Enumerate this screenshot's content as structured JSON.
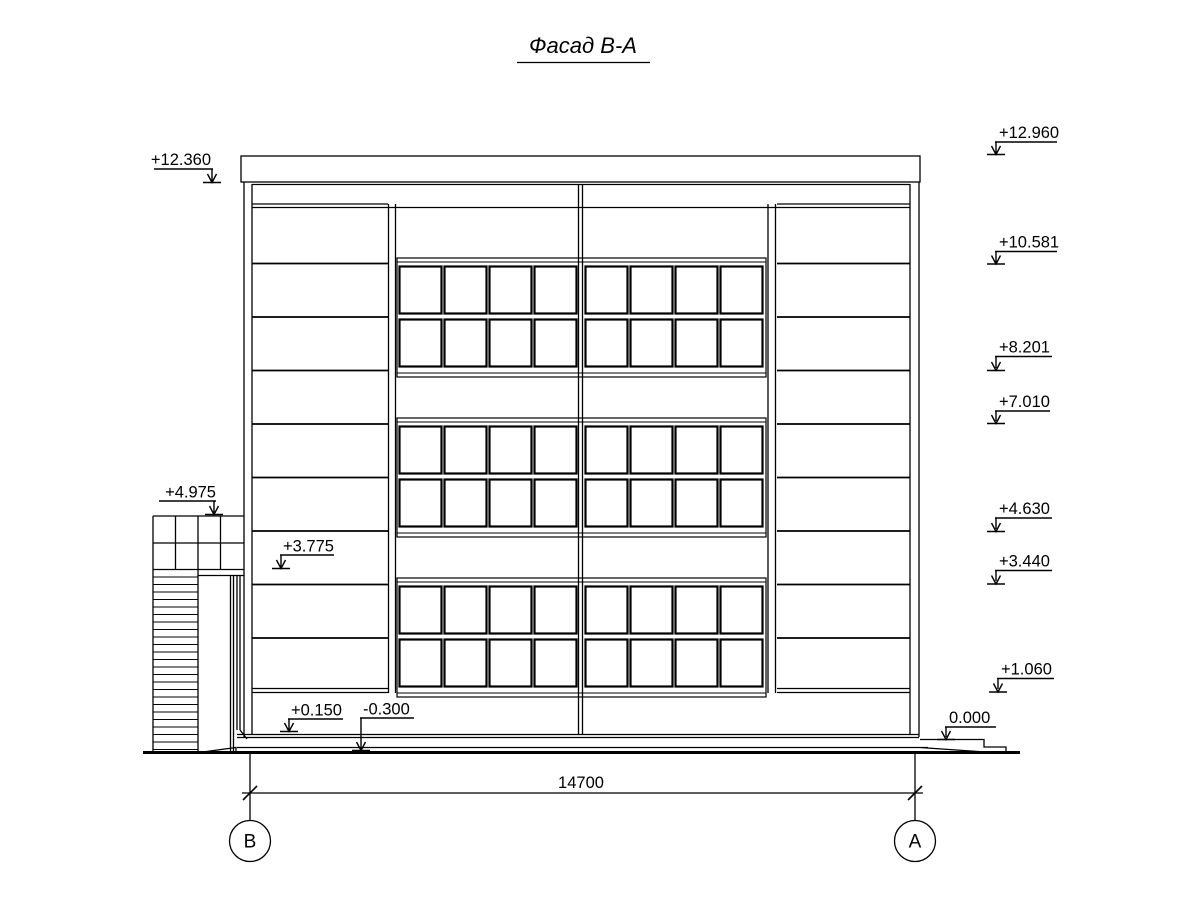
{
  "title": "Фасад В-А",
  "dimension": {
    "value": "14700"
  },
  "axis_markers": {
    "left": "В",
    "right": "А"
  },
  "elevation_marks_left": [
    {
      "label": "+12.360"
    },
    {
      "label": "+4.975"
    },
    {
      "label": "+3.775"
    },
    {
      "label": "+0.150"
    },
    {
      "label": "-0.300"
    }
  ],
  "elevation_marks_right": [
    {
      "label": "+12.960"
    },
    {
      "label": "+10.581"
    },
    {
      "label": "+8.201"
    },
    {
      "label": "+7.010"
    },
    {
      "label": "+4.630"
    },
    {
      "label": "+3.440"
    },
    {
      "label": "+1.060"
    },
    {
      "label": "0.000"
    }
  ]
}
